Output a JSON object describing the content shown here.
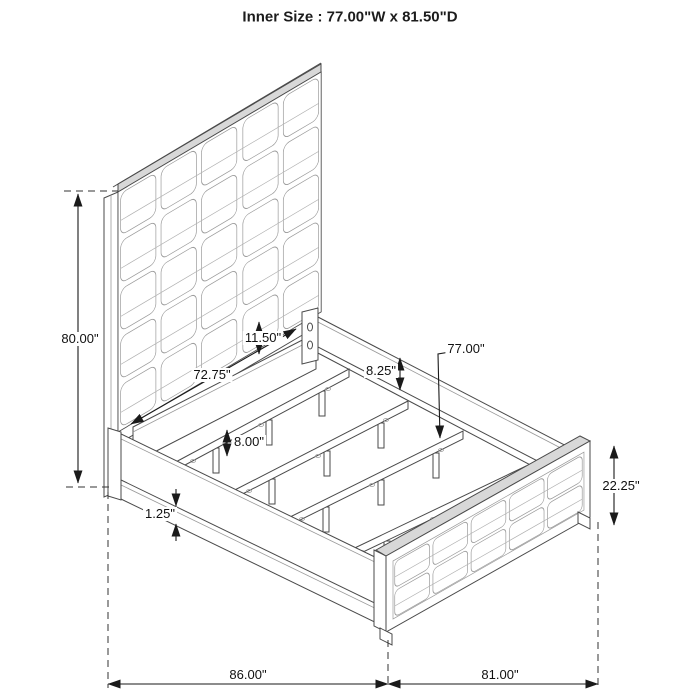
{
  "title": "Inner Size : 77.00\"W x 81.50\"D",
  "dimensions": {
    "headboard_height": "80.00\"",
    "headboard_rail_width": "11.50\"",
    "slat_rail_length": "72.75\"",
    "side_rail_height": "8.25\"",
    "inner_width": "77.00\"",
    "slat_leg_height": "8.00\"",
    "rail_trim_height": "1.25\"",
    "footboard_height": "22.25\"",
    "overall_depth": "86.00\"",
    "overall_width": "81.00\""
  }
}
